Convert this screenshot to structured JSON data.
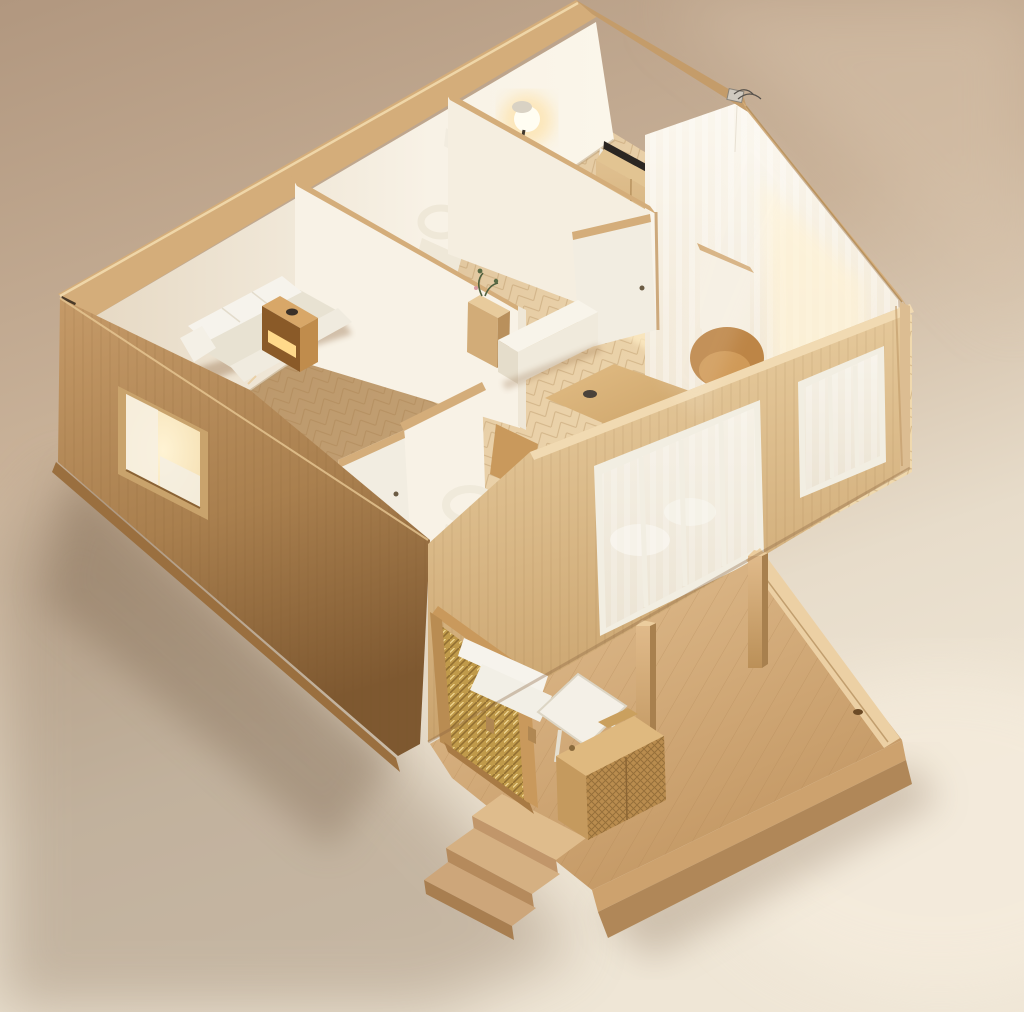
{
  "scene": {
    "type": "photorealistic-3d-render",
    "subject": "isometric cutaway model of a single-storey wooden house",
    "description": "High-angle aerial view of a miniature dollhouse-style architectural model: light oak exterior walls cut open to reveal white interior rooms with a sofa, glowing nightstand, desk lamp, wardrobe, dining table, tan armchair and sheer curtains along a sloped glass wall; a wooden deck with posts, a white bench and table, a woven rattan console, a brass woven screen and front steps sits at the lower right; warm studio backdrop with soft shadow falling to the lower left.",
    "camera": "three-quarter top-down isometric",
    "lighting": "warm sunlight from upper right",
    "visible_text": ""
  },
  "canvas": {
    "width": 1024,
    "height": 1012
  },
  "palette": {
    "bg_top": "#b1977f",
    "bg_mid": "#c9b299",
    "bg_floor": "#e7dcca",
    "bg_floor_lo": "#efe6d6",
    "bg_light": "#d8c3ab",
    "shadow": "#8f7860",
    "trim": "#d4ad7a",
    "trim_hi": "#efd6a8",
    "trim_dark": "#c49c6a",
    "wood_left_hi": "#c59a68",
    "wood_left_lo": "#7e5830",
    "wood_front_hi": "#ecd2a6",
    "wood_front_lo": "#c9a26c",
    "wood_cut": "#f1dab2",
    "deck_hi": "#e3c092",
    "deck_lo": "#c29662",
    "deck_edge": "#ecd0a4",
    "deck_fascia": "#cda26e",
    "deck_fascia_lo": "#b08758",
    "plank_line": "#a87c4c",
    "wall_white": "#f8f2e6",
    "wall_shade": "#e6d9c4",
    "floor_hi": "#e9d0a8",
    "floor_lo": "#cdb089",
    "floor_dark": "#9e7240",
    "herring_line": "#b08a58",
    "sun": "#ffeec6",
    "glow": "#ffd98a",
    "fabric": "#f6f3ec",
    "fabric_shade": "#e8e2d2",
    "armchair": "#bd8546",
    "armchair_hi": "#d09a58",
    "brass": "#c09a4a",
    "brass_dark": "#7e5c28",
    "brass_hi": "#ffe9a8",
    "door": "#f2ede1",
    "glass": "#f6f1e6",
    "curtain": "#fbf7ee",
    "metal_dark": "#2b2622",
    "wood_mid": "#c9995c",
    "wood_box": "#d8a768",
    "wood_box_dark": "#8a5a28",
    "plant": "#50603e",
    "frame_white": "#f2eee2"
  },
  "objects": {
    "backdrop": "seamless warm studio backdrop",
    "cast_shadow": "soft shadow cast by the model to the lower left",
    "interior_floor": "herringbone oak interior floor with sun patches",
    "back_wall": "white back wall with oak cap trim",
    "left_wall": "oak exterior side wall with lit window",
    "front_wall": "oak front wall with two glazed window walls",
    "sloped_glass": "sloped glass roof edge with sheer curtains",
    "roof_beam": "oak sloped roof beam with cable fixture",
    "partition_bedroom": "white partition wall of the bedroom",
    "partition_office": "white partition wall of the office nook",
    "panel_screen": "small white freestanding panel",
    "door_living": "open white interior door in the living room",
    "door_bedroom2": "open white door of the second bedroom",
    "bedroom2_wall": "white corner wall of the second bedroom",
    "sofa": "white fabric sofa in the bedroom",
    "nightstand": "oak nightstand with warm glowing niche",
    "desk": "small desk against the back wall",
    "desk_lamp": "glowing desk lamp",
    "office_chair": "cream chair in the office nook",
    "wardrobe": "oak wardrobe with double doors and black device on top",
    "credenza": "long white credenza",
    "plant_cabinet": "small oak cabinet with a plant",
    "dining_table": "oak dining table with dark tableware",
    "dining_chairs": "oak dining chairs",
    "armchair": "camel tub armchair",
    "side_chair": "white chair near the front window",
    "deck": "wooden deck terrace with stepped fascia",
    "deck_steps": "corner steps of the deck",
    "deck_posts": "two square pergola posts",
    "woven_screen": "brass woven privacy screen",
    "deck_bench": "outdoor bench with white cushion",
    "deck_table": "white outdoor table",
    "woven_console": "rattan woven console on the deck",
    "window_left": "warmly lit window in the left wall",
    "window_a": "four-pane window wall of the living room",
    "window_b": "three-pane window at the right corner"
  }
}
